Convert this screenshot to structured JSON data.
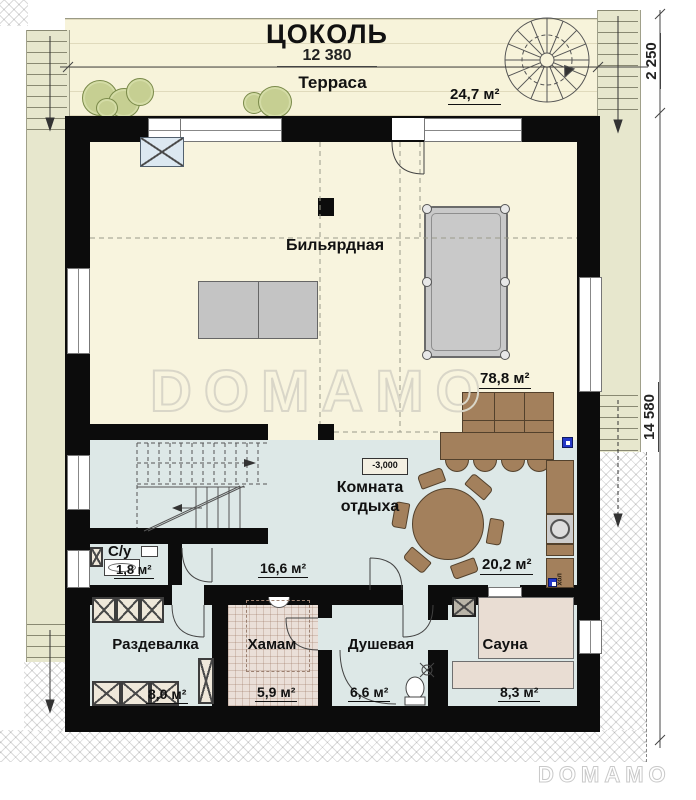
{
  "plan": {
    "floor_title": "ЦОКОЛЬ"
  },
  "dimensions": {
    "top_width": "12 380",
    "right_upper": "2 250",
    "right_total": "14 580"
  },
  "terrace": {
    "name": "Терраса",
    "area": "24,7 м²"
  },
  "rooms": {
    "billiard": {
      "name": "Бильярдная",
      "area": "78,8 м²"
    },
    "lounge": {
      "name_line1": "Комната",
      "name_line2": "отдыха",
      "area": "20,2 м²",
      "elevation": "-3,000"
    },
    "wc": {
      "name": "С/у",
      "area": "1,8 м²"
    },
    "hall": {
      "area": "16,6 м²"
    },
    "dressing": {
      "name": "Раздевалка",
      "area": "8,0 м²"
    },
    "hamam": {
      "name": "Хамам",
      "area": "5,9 м²"
    },
    "shower": {
      "name": "Душевая",
      "area": "6,6 м²"
    },
    "sauna": {
      "name": "Сауна",
      "area": "8,3 м²"
    }
  },
  "furniture": {
    "fridge_label": "хол"
  },
  "watermark": {
    "text": "DOMAMO"
  },
  "colors": {
    "wall": "#0c0c0c",
    "floor_cream": "#f8f4de",
    "floor_blue": "#dde8e7",
    "walkway": "#e7e7cd",
    "furniture_brown": "#a3805c",
    "hamam_floor": "#eadfd8",
    "bench": "#e9ddd3",
    "fireplace_blue": "#dce8f1",
    "accent_blue": "#2438c8",
    "pool_table_gray": "#c9c9c9"
  }
}
